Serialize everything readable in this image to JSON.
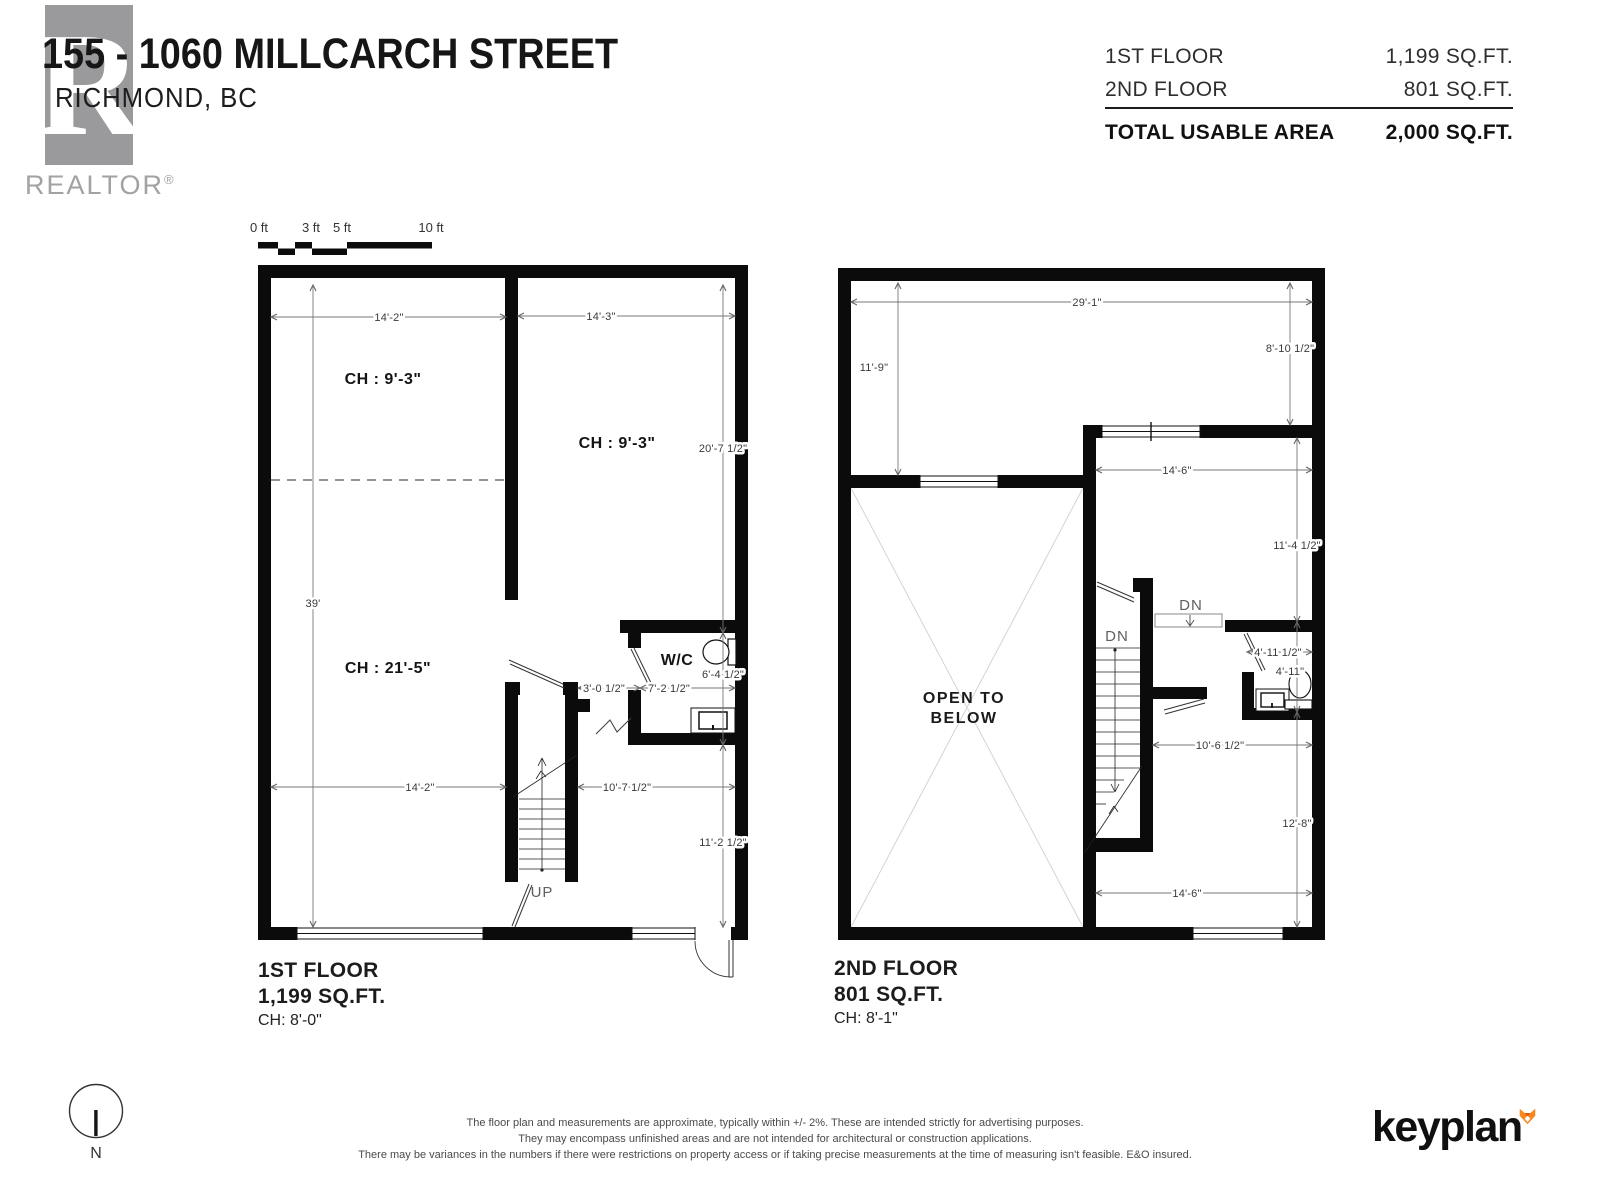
{
  "header": {
    "title": "155 - 1060 MILLCARCH STREET",
    "subtitle": "RICHMOND, BC",
    "realtor_letter": "R",
    "realtor_word": "REALTOR",
    "realtor_reg": "®"
  },
  "area_summary": {
    "rows": [
      {
        "label": "1ST FLOOR",
        "value": "1,199 SQ.FT."
      },
      {
        "label": "2ND FLOOR",
        "value": "801 SQ.FT."
      }
    ],
    "total_label": "TOTAL USABLE AREA",
    "total_value": "2,000 SQ.FT."
  },
  "scale_bar": {
    "labels": [
      "0 ft",
      "3 ft",
      "5 ft",
      "10 ft"
    ]
  },
  "north": {
    "label": "N"
  },
  "floor1": {
    "caption": {
      "name": "1ST FLOOR",
      "area": "1,199 SQ.FT.",
      "ch": "CH: 8'-0\""
    },
    "rooms": {
      "ch_top_left": "CH : 9'-3\"",
      "ch_top_right": "CH : 9'-3\"",
      "ch_main": "CH : 21'-5\"",
      "wc": "W/C",
      "up": "UP"
    },
    "dims": {
      "top_left": "14'-2\"",
      "top_right": "14'-3\"",
      "left": "39'",
      "right_upper": "20'-7 1/2\"",
      "wc_height": "6'-4 1/2\"",
      "right_lower": "11'-2 1/2\"",
      "mid_left": "14'-2\"",
      "mid_right": "10'-7 1/2\"",
      "stair_door": "3'-0 1/2\"",
      "wc_width": "7'-2 1/2\""
    }
  },
  "floor2": {
    "caption": {
      "name": "2ND FLOOR",
      "area": "801 SQ.FT.",
      "ch": "CH: 8'-1\""
    },
    "rooms": {
      "open1": "OPEN TO",
      "open2": "BELOW",
      "dn_stair": "DN",
      "dn_steps": "DN"
    },
    "dims": {
      "top": "29'-1\"",
      "left": "11'-9\"",
      "right_upper": "8'-10 1/2\"",
      "room_width": "14'-6\"",
      "right_mid": "11'-4 1/2\"",
      "bath_door": "4'-11 1/2\"",
      "bath_height": "4'-11\"",
      "hall": "10'-6 1/2\"",
      "right_lower": "12'-8\"",
      "bottom": "14'-6\""
    }
  },
  "footer": {
    "disclaimer": [
      "The floor plan and measurements are approximate, typically within +/- 2%. These are intended strictly for advertising purposes.",
      "They may encompass unfinished areas and are not intended for architectural or construction applications.",
      "There may be variances in the numbers if there were restrictions on property access or if taking precise measurements at the time of measuring isn't feasible. E&O insured."
    ],
    "brand": "keyplan"
  }
}
